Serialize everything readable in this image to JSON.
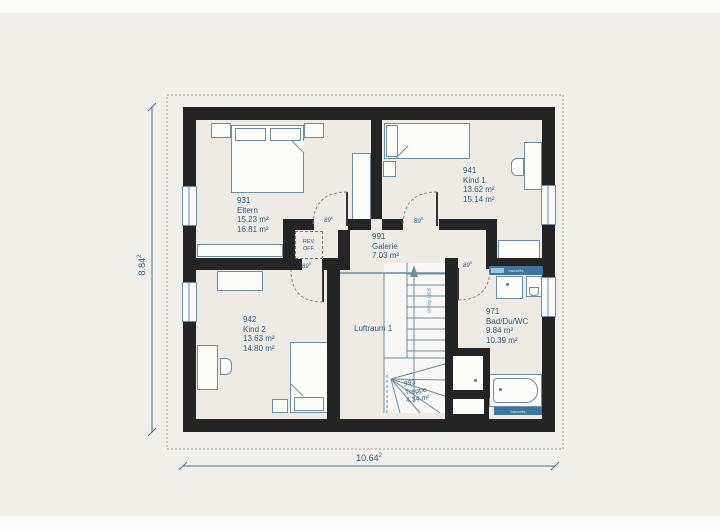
{
  "rooms": {
    "eltern": {
      "number": "931",
      "name": "Eltern",
      "area1": "15.23 m²",
      "area2": "16.81 m²"
    },
    "kind1": {
      "number": "941",
      "name": "Kind 1",
      "area1": "13.62 m²",
      "area2": "15.14 m²"
    },
    "kind2": {
      "number": "942",
      "name": "Kind 2",
      "area1": "13.63 m²",
      "area2": "14.80 m²"
    },
    "bad": {
      "number": "971",
      "name": "Bad/Du/WC",
      "area1": "9.84 m²",
      "area2": "10.39 m²"
    },
    "galerie": {
      "number": "991",
      "name": "Galerie",
      "area1": "7.03 m²"
    },
    "treppe": {
      "number": "993",
      "name": "Treppe",
      "area1": "4.34 m²"
    },
    "luftraum": {
      "name": "Luftraum 1"
    }
  },
  "dimensions": {
    "height": "8.84",
    "height_sup": "2",
    "width": "10.64",
    "width_sup": "2"
  },
  "annotations": {
    "door_angle": "89",
    "door_angle_sup": "5",
    "shaft_line1": "REV.",
    "shaft_line2": "OFF.",
    "stair_note": "18 Stg 18/25",
    "radiator_label": "bauseits"
  },
  "colors": {
    "background": "#f1efe9",
    "floor": "#edebe3",
    "wall": "#242424",
    "furniture_line": "#6b8ca3",
    "label_text": "#2e5c7d",
    "radiator": "#3e76a0"
  }
}
